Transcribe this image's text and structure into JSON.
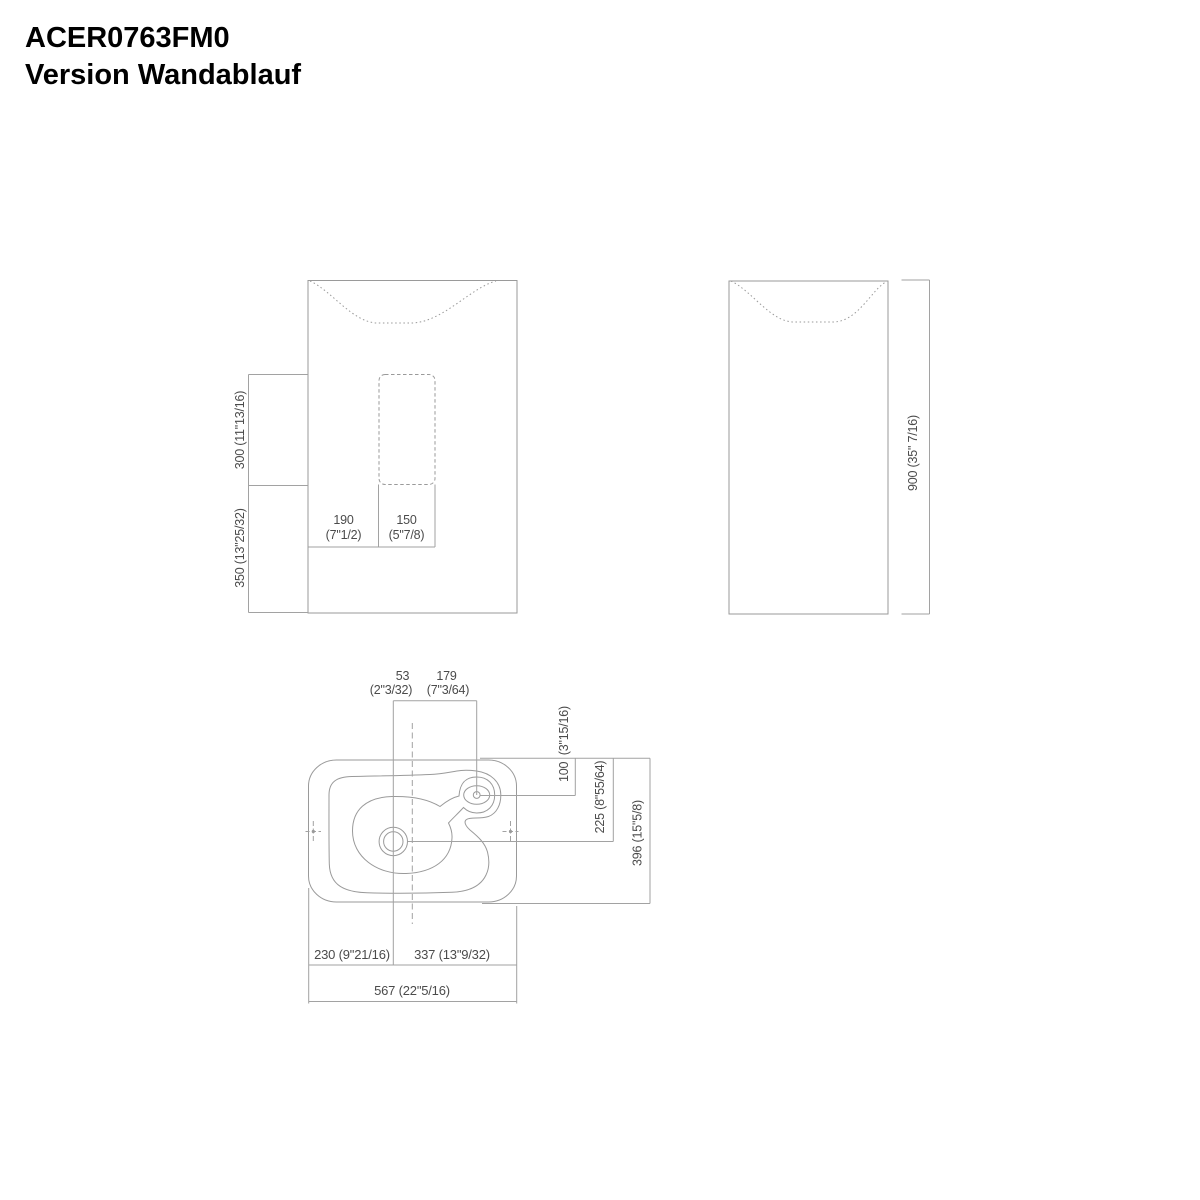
{
  "title": {
    "product_code": "ACER0763FM0",
    "variant": "Version Wandablauf"
  },
  "drawing": {
    "line_color": "#9a9a9a",
    "text_color": "#4b4b4b",
    "views": [
      "front-view",
      "side-view",
      "top-view"
    ]
  },
  "dims": {
    "front": {
      "slot_offset_mm": "190",
      "slot_offset_in": "(7\"1/2)",
      "slot_width_mm": "150",
      "slot_width_in": "(5\"7/8)",
      "slot_height": "300 (11\"13/16)",
      "below_slot_height": "350 (13\"25/32)"
    },
    "side": {
      "total_height": "900 (35\" 7/16)"
    },
    "top": {
      "drain_to_centerline_mm": "53",
      "drain_to_centerline_in": "(2\"3/32)",
      "centerline_to_tap_mm": "179",
      "centerline_to_tap_in": "(7\"3/64)",
      "tap_from_back": "100  (3\"15/16)",
      "drain_from_back": "225 (8\"55/64)",
      "total_depth": "396 (15\"5/8)",
      "left_to_drain": "230 (9\"21/16)",
      "drain_to_right": "337 (13\"9/32)",
      "total_width": "567 (22\"5/16)"
    }
  }
}
